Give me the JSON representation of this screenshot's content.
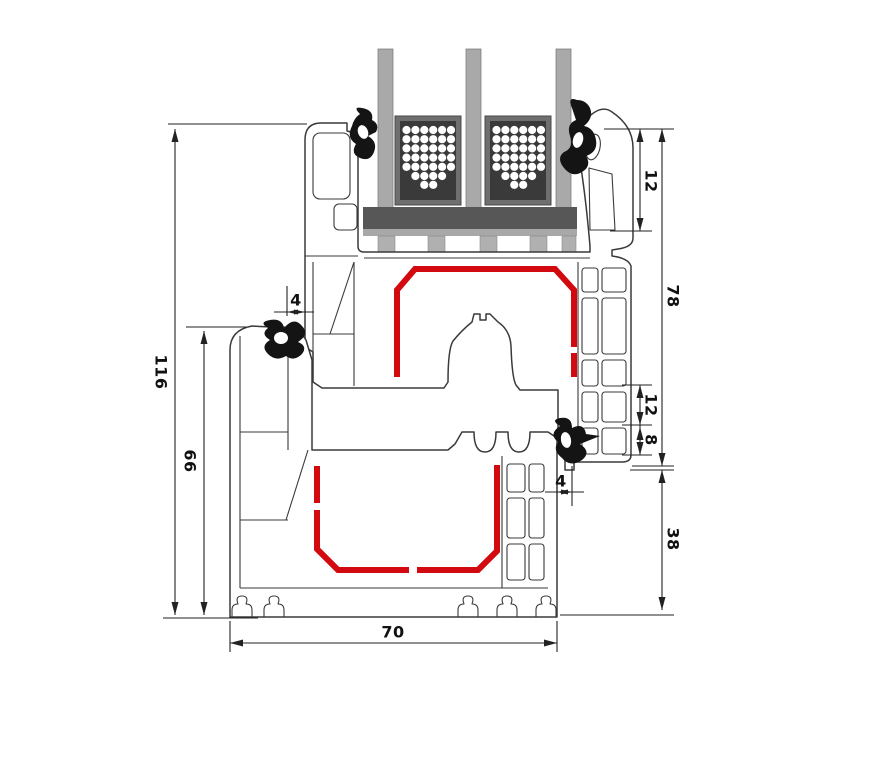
{
  "drawing": {
    "type": "window-profile-cross-section",
    "dimensions_mm": {
      "total_height": "116",
      "frame_height": "66",
      "frame_width": "70",
      "sash_height": "78",
      "frame_face_below_sash": "38",
      "glazing_edge_cover": "12",
      "chamber_mid": "12",
      "chamber_small": "8",
      "gap_left": "4",
      "gap_right": "4"
    },
    "colors": {
      "steel_reinforcement": "#d20a10",
      "gasket": "#141414",
      "glass": "#a9a9a9",
      "spacer_body": "#3a3a3a",
      "spacer_frame": "#6f6f6f",
      "setting_block": "#575757",
      "profile_outline": "#3a3a3a",
      "dimension_lines": "#222222"
    }
  }
}
